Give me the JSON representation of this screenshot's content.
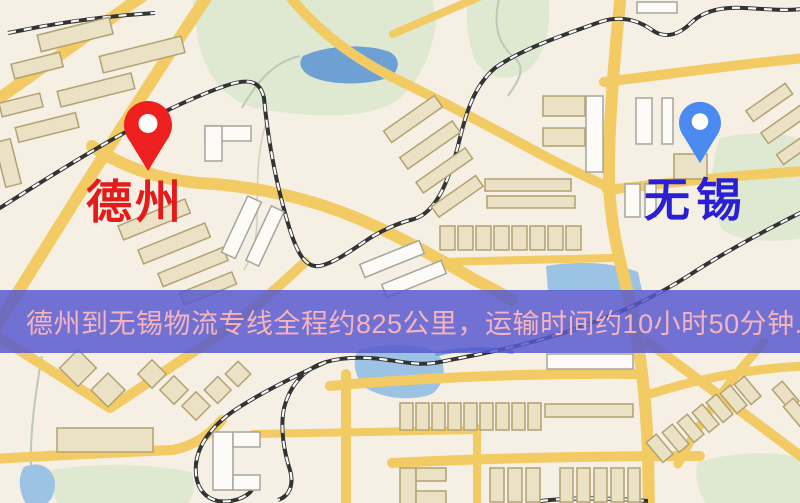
{
  "map": {
    "markers": {
      "origin": {
        "label": "德州",
        "pin_color": "#ee1f1f",
        "label_color": "#e41b1b"
      },
      "destination": {
        "label": "无锡",
        "pin_color": "#4b8af0",
        "label_color": "#2a1fd4"
      }
    },
    "banner": {
      "text": "德州到无锡物流专线全程约825公里，运输时间约10小时50分钟.",
      "route_from": "德州",
      "route_to": "无锡",
      "distance": "约825公里",
      "duration": "约10小时50分钟",
      "background_color": "#5658ce",
      "text_color": "#f6b3bd"
    },
    "legend_colors": {
      "map_background": "#f6efe3",
      "road": "#f2cb64",
      "park": "#dfe9d2",
      "water": "#6fa0d4",
      "railway": "#333333",
      "building_beige": "#ebe2c5",
      "building_white": "#fcfbf7"
    }
  }
}
